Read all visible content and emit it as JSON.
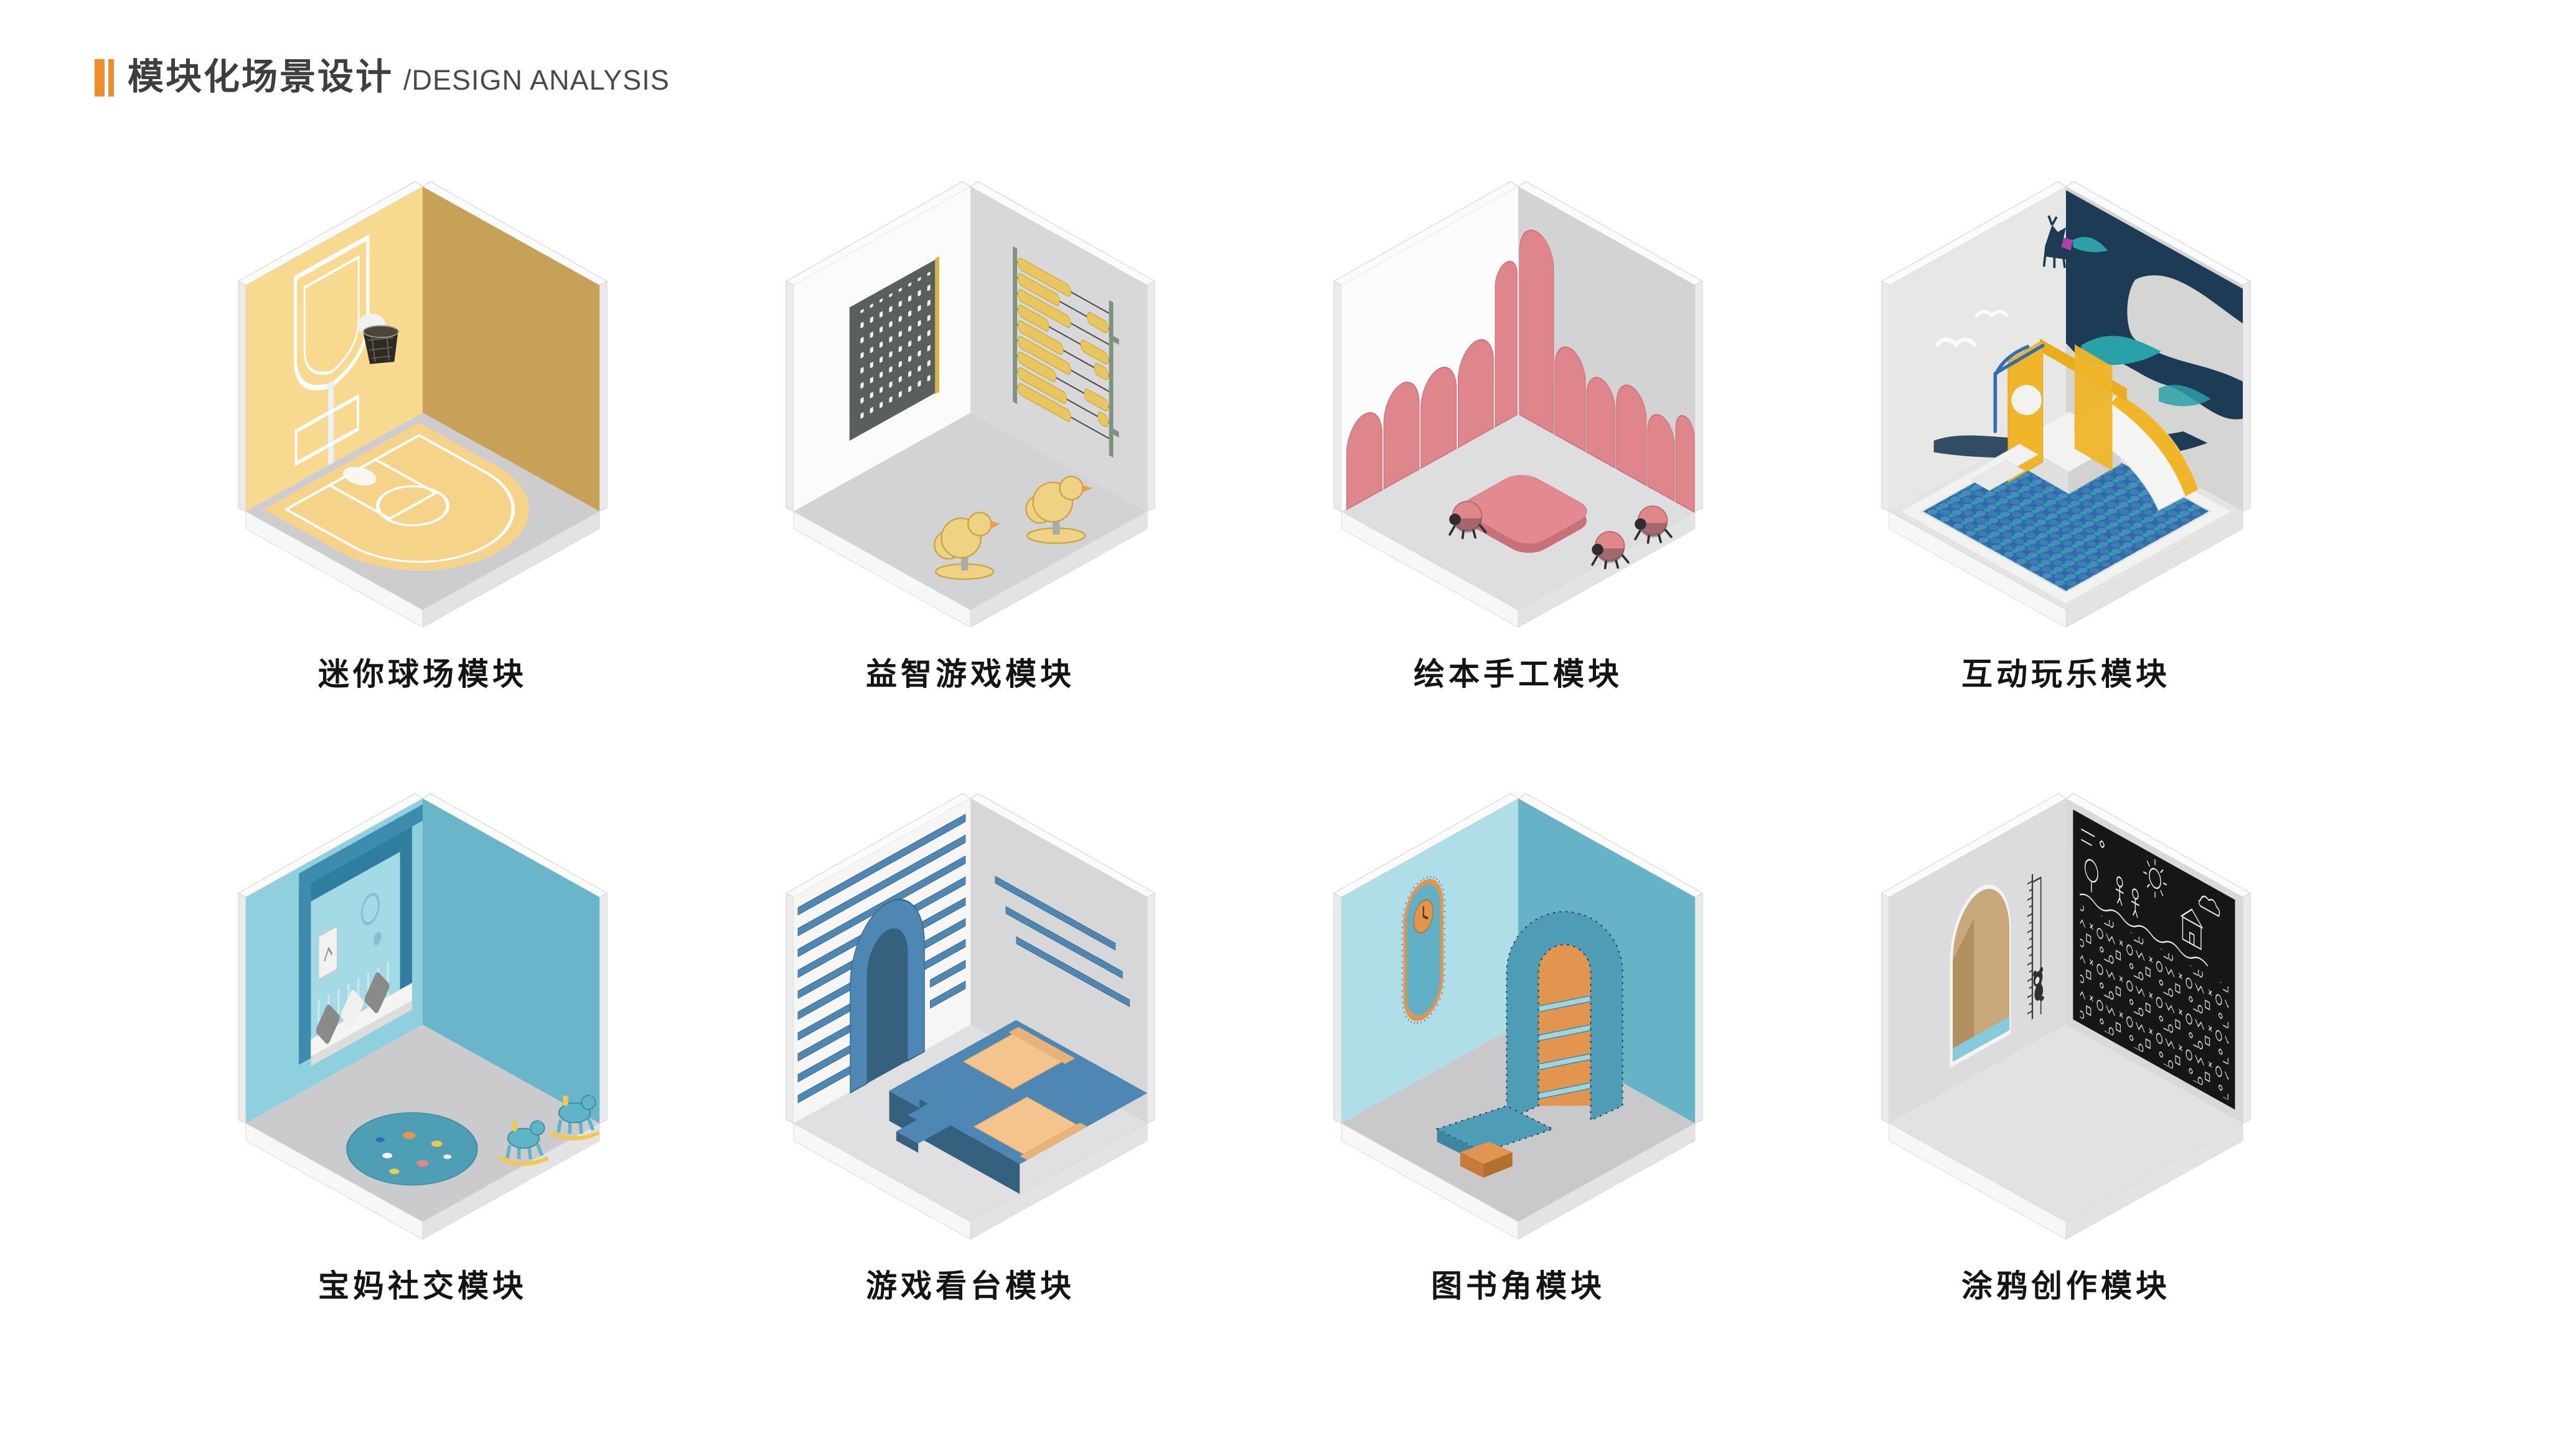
{
  "header": {
    "title_zh": "模块化场景设计",
    "subtitle_en": "/DESIGN ANALYSIS",
    "colors": {
      "accent": "#EF8C30"
    }
  },
  "modules": [
    {
      "id": "mini-court",
      "label": "迷你球场模块",
      "colors": {
        "wallL": "#F8D990",
        "wallR": "#C8A158",
        "floor": "#CDCDCF",
        "court": "#F5D489",
        "line": "#FFFFFF",
        "hoop": "#2E2A24",
        "pole": "#EFEFED"
      }
    },
    {
      "id": "puzzle-games",
      "label": "益智游戏模块",
      "colors": {
        "wallL": "#FBFBFB",
        "wallR": "#D8D8DA",
        "floor": "#D3D3D5",
        "board": "#5A5E5E",
        "boardEdge": "#D9B348",
        "bead": "#E9C75F",
        "toy": "#F0D285"
      }
    },
    {
      "id": "book-craft",
      "label": "绘本手工模块",
      "colors": {
        "wallL": "#FCFCFC",
        "wallR": "#D3D3D5",
        "floor": "#DEDEE0",
        "panel": "#DE868B",
        "panelEdge": "#C87179",
        "table": "#E28A8F",
        "bug": "#2E2E2E"
      }
    },
    {
      "id": "interactive-play",
      "label": "互动玩乐模块",
      "colors": {
        "wallL": "#E7E7E5",
        "wallR": "#D5D5D3",
        "floor": "#E4E4E2",
        "mural": "#1D3B54",
        "mural2": "#2AA0A8",
        "frame": "#F0B528",
        "slide": "#F5F5F3",
        "rail": "#2F6FB4",
        "ball": "#3F7CB5",
        "ball2": "#2D6CA6",
        "deerAccent": "#B33FA8"
      }
    },
    {
      "id": "mom-social",
      "label": "宝妈社交模块",
      "colors": {
        "wallL": "#8FD0DE",
        "wallR": "#69B6CB",
        "floor": "#CBCBCD",
        "niche": "#2F7E9F",
        "nicheBack": "#A3DAE5",
        "shelf": "#3E8CAD",
        "bench": "#F4F4F2",
        "pillow": "#8A8A88",
        "rug": "#4E9FB5",
        "pony": "#5FB4C8",
        "rocker": "#F2C94C"
      }
    },
    {
      "id": "grandstand",
      "label": "游戏看台模块",
      "colors": {
        "wallL": "#F6F6F4",
        "wallR": "#D7D7D9",
        "floor": "#E0E0E2",
        "slat": "#4E87B4",
        "slatDark": "#35617F",
        "cushion": "#F3C48D"
      }
    },
    {
      "id": "book-corner",
      "label": "图书角模块",
      "colors": {
        "wallL": "#AFDEE9",
        "wallR": "#66B2C7",
        "floor": "#C9C9CB",
        "curl": "#4E9CB5",
        "curlDark": "#3D86A0",
        "orange": "#E2954F"
      }
    },
    {
      "id": "graffiti",
      "label": "涂鸦创作模块",
      "colors": {
        "wallL": "#DCDCDE",
        "wallR": "#D9D9DB",
        "floor": "#E2E2E4",
        "arch": "#C9A87B",
        "archDark": "#B2905F",
        "seat": "#86CBDC",
        "board": "#161616",
        "chalk": "#EAEAEA"
      }
    }
  ]
}
